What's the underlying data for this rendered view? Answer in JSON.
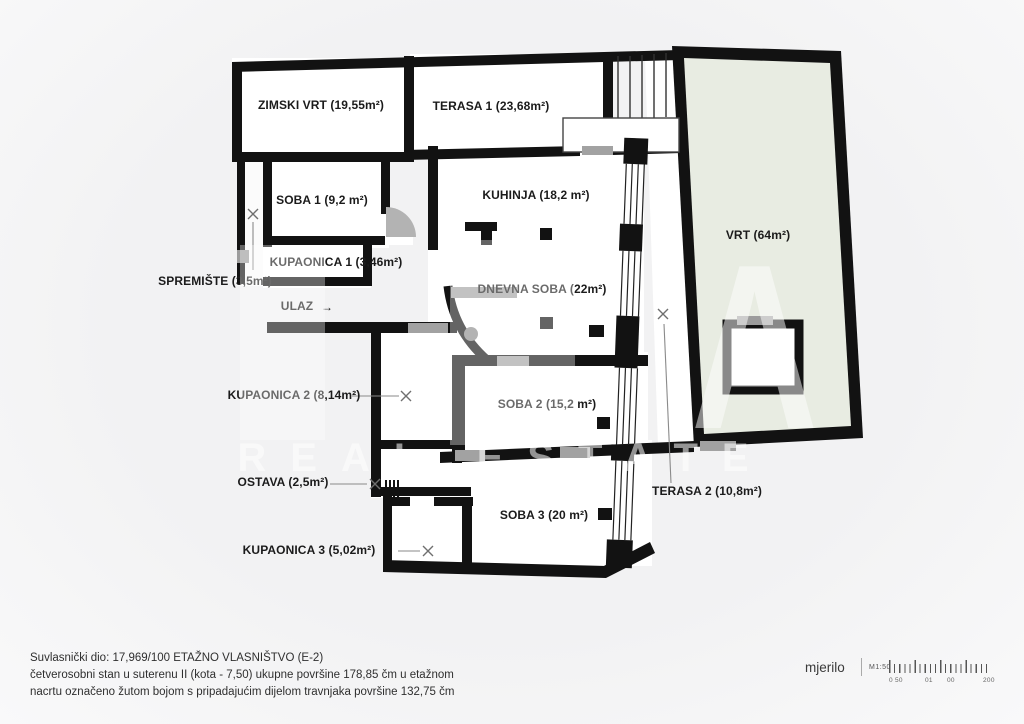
{
  "plan": {
    "rooms": {
      "zimski_vrt": "ZIMSKI VRT (19,55m²)",
      "terasa_1": "TERASA 1 (23,68m²)",
      "vrt": "VRT (64m²)",
      "soba_1": "SOBA 1 (9,2 m²)",
      "kupaonica_1": "KUPAONICA 1 (3,46m²)",
      "spremiste": "SPREMIŠTE (3,5m²)",
      "ulaz": "ULAZ",
      "ulaz_arrow": "→",
      "kuhinja": "KUHINJA (18,2 m²)",
      "dnevna_soba": "DNEVNA SOBA (22m²)",
      "kupaonica_2": "KUPAONICA 2 (8,14m²)",
      "soba_2": "SOBA 2 (15,2 m²)",
      "ostava": "OSTAVA (2,5m²)",
      "terasa_2": "TERASA 2 (10,8m²)",
      "kupaonica_3": "KUPAONICA 3 (5,02m²)",
      "soba_3": "SOBA 3 (20 m²)"
    }
  },
  "watermark": {
    "letter": "A",
    "caption": "REAL ESTATE"
  },
  "footer": {
    "line1": "Suvlasnički dio: 17,969/100 ETAŽNO VLASNIŠTVO (E-2)",
    "line2": "četverosobni stan u suterenu II (kota - 7,50) ukupne površine 178,85 čm u etažnom",
    "line3": "nacrtu označeno žutom bojom s pripadajućim dijelom travnjaka površine 132,75 čm"
  },
  "scalebar": {
    "label": "mjerilo",
    "ratio": "M1:50",
    "tick_labels": [
      "0 50",
      "01",
      "00",
      "200"
    ]
  },
  "colors": {
    "wall": "#121212",
    "garden_fill": "#e8ece2",
    "door_gray": "#a2a2a2",
    "background": "#f2f2f3"
  }
}
